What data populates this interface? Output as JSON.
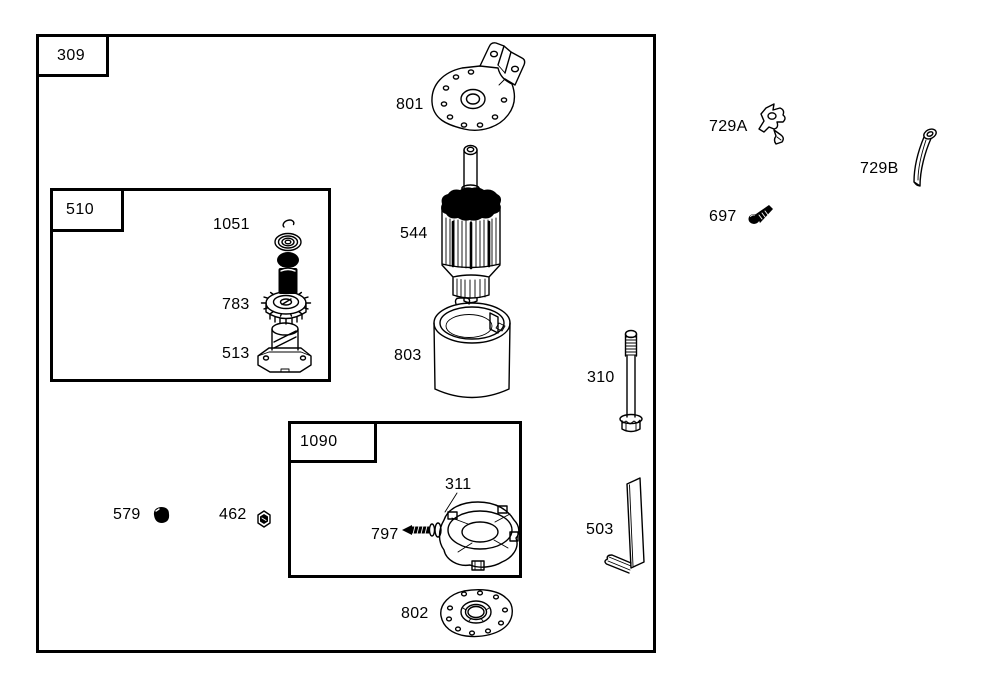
{
  "colors": {
    "line": "#000000",
    "background": "#ffffff"
  },
  "labels": {
    "box_309": "309",
    "box_510": "510",
    "box_1090": "1090",
    "part_801": "801",
    "part_544": "544",
    "part_803": "803",
    "part_1051": "1051",
    "part_783": "783",
    "part_513": "513",
    "part_311": "311",
    "part_797": "797",
    "part_579": "579",
    "part_462": "462",
    "part_802": "802",
    "part_310": "310",
    "part_503": "503",
    "part_729A": "729A",
    "part_729B": "729B",
    "part_697": "697"
  }
}
